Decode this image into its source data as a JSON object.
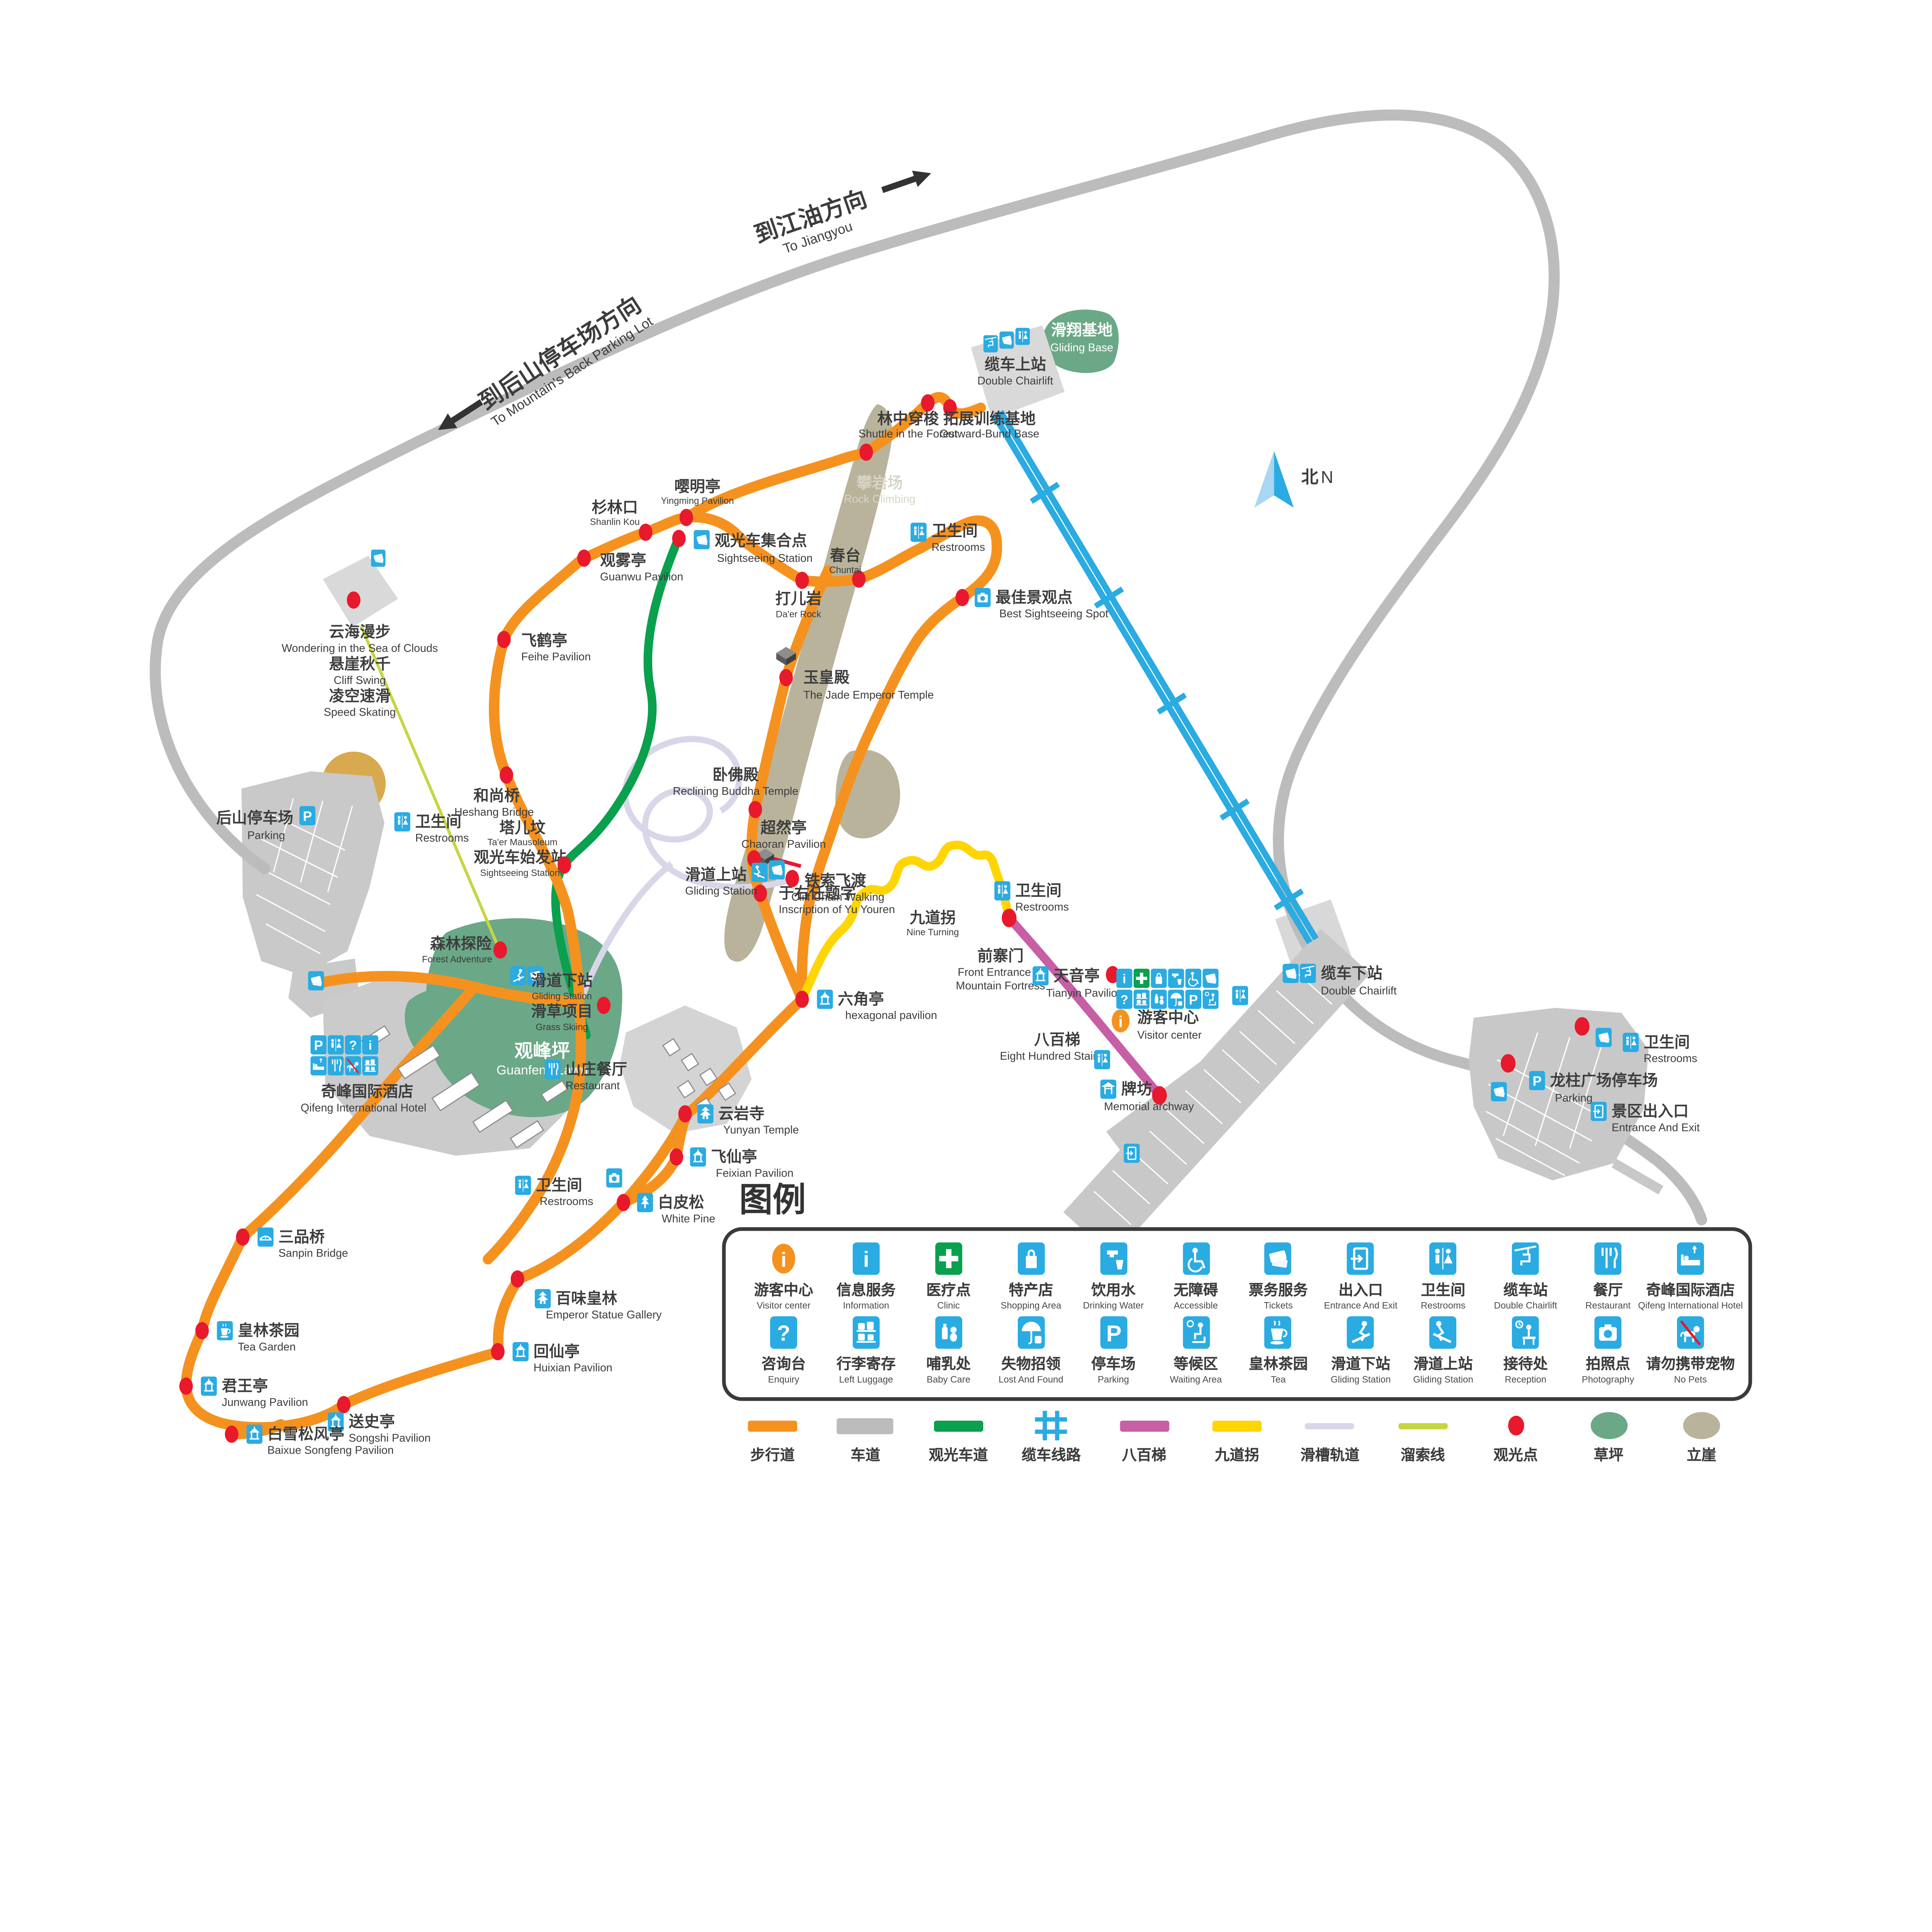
{
  "map": {
    "compass": {
      "zh": "北",
      "en": "N"
    },
    "directions": {
      "jiangyou": {
        "zh": "到江油方向",
        "en": "To Jiangyou"
      },
      "backparking": {
        "zh": "到后山停车场方向",
        "en": "To Mountain's Back Parking Lot"
      }
    },
    "pois": {
      "glidingBase": {
        "zh": "滑翔基地",
        "en": "Gliding Base"
      },
      "chairliftTop": {
        "zh": "缆车上站",
        "en": "Double Chairlift"
      },
      "chairliftBottom": {
        "zh": "缆车下站",
        "en": "Double Chairlift"
      },
      "shuttleForest": {
        "zh": "林中穿梭",
        "en": "Shuttle in the Forest"
      },
      "outwardBase": {
        "zh": "拓展训练基地",
        "en": "Outward-Bund Base"
      },
      "rockClimbing": {
        "zh": "攀岩场",
        "en": "Rock Climbing"
      },
      "shanlinkou": {
        "zh": "杉林口",
        "en": "Shanlin Kou"
      },
      "yingming": {
        "zh": "嘤明亭",
        "en": "Yingming Pavilion"
      },
      "sightseeingStation": {
        "zh": "观光车集合点",
        "en": "Sightseeing Station"
      },
      "restrooms": {
        "zh": "卫生间",
        "en": "Restrooms"
      },
      "chuntai": {
        "zh": "春台",
        "en": "Chuntai"
      },
      "daerRock": {
        "zh": "打儿岩",
        "en": "Da'er Rock"
      },
      "bestSpot": {
        "zh": "最佳景观点",
        "en": "Best Sightseeing Spot"
      },
      "guanwu": {
        "zh": "观雾亭",
        "en": "Guanwu Pavilion"
      },
      "feihe": {
        "zh": "飞鹤亭",
        "en": "Feihe Pavilion"
      },
      "seaOfClouds": {
        "zh": "云海漫步",
        "en": "Wondering in the Sea of Clouds"
      },
      "cliffSwing": {
        "zh": "悬崖秋千",
        "en": "Cliff Swing"
      },
      "speedSkating": {
        "zh": "凌空速滑",
        "en": "Speed Skating"
      },
      "jadeEmperor": {
        "zh": "玉皇殿",
        "en": "The Jade Emperor Temple"
      },
      "recliningBuddha": {
        "zh": "卧佛殿",
        "en": "Reclining Buddha Temple"
      },
      "chaoran": {
        "zh": "超然亭",
        "en": "Chaoran Pavilion"
      },
      "cliffChain": {
        "zh": "铁索飞渡",
        "en": "Cliff Chain Walking"
      },
      "yuYouren": {
        "zh": "于右任题字",
        "en": "Inscription of Yu Youren"
      },
      "heshang": {
        "zh": "和尚桥",
        "en": "Heshang Bridge"
      },
      "glidingUpper": {
        "zh": "滑道上站",
        "en": "Gliding Station"
      },
      "taerMausoleum": {
        "zh": "塔儿坟",
        "en": "Ta'er Mausoleum"
      },
      "sightseeingStart": {
        "zh": "观光车始发站",
        "en": "Sightseeing Station"
      },
      "forestAdventure": {
        "zh": "森林探险",
        "en": "Forest Adventure"
      },
      "glidingLower": {
        "zh": "滑道下站",
        "en": "Gliding Station"
      },
      "grassSkiing": {
        "zh": "滑草项目",
        "en": "Grass Skiing"
      },
      "guanfengLawn": {
        "zh": "观峰坪",
        "en": "Guanfeng Lawn"
      },
      "backParking": {
        "zh": "后山停车场",
        "en": "Parking"
      },
      "hotel": {
        "zh": "奇峰国际酒店",
        "en": "Qifeng International Hotel"
      },
      "villaRestaurant": {
        "zh": "山庄餐厅",
        "en": "Restaurant"
      },
      "yunyan": {
        "zh": "云岩寺",
        "en": "Yunyan Temple"
      },
      "feixian": {
        "zh": "飞仙亭",
        "en": "Feixian Pavilion"
      },
      "whitePine": {
        "zh": "白皮松",
        "en": "White Pine"
      },
      "sanpin": {
        "zh": "三品桥",
        "en": "Sanpin Bridge"
      },
      "emperorGallery": {
        "zh": "百味皇林",
        "en": "Emperor Statue Gallery"
      },
      "teaGarden": {
        "zh": "皇林茶园",
        "en": "Tea Garden"
      },
      "huixian": {
        "zh": "回仙亭",
        "en": "Huixian Pavilion"
      },
      "junwang": {
        "zh": "君王亭",
        "en": "Junwang Pavilion"
      },
      "songshi": {
        "zh": "送史亭",
        "en": "Songshi Pavilion"
      },
      "baixue": {
        "zh": "白雪松风亭",
        "en": "Baixue Songfeng Pavilion"
      },
      "hexagonal": {
        "zh": "六角亭",
        "en": "hexagonal pavilion"
      },
      "nineTurning": {
        "zh": "九道拐",
        "en": "Nine Turning"
      },
      "frontEntrance": {
        "zh": "前寨门",
        "en1": "Front Entrance of",
        "en2": "Mountain Fortress"
      },
      "tianyin": {
        "zh": "天音亭",
        "en": "Tianyin Pavilion"
      },
      "eightHundred": {
        "zh": "八百梯",
        "en": "Eight Hundred Stairs"
      },
      "archway": {
        "zh": "牌坊",
        "en": "Memorial archway"
      },
      "visitorCenter": {
        "zh": "游客中心",
        "en": "Visitor center"
      },
      "longzhuParking": {
        "zh": "龙柱广场停车场",
        "en": "Parking"
      },
      "entranceExit": {
        "zh": "景区出入口",
        "en": "Entrance And Exit"
      }
    }
  },
  "legend": {
    "title": "图例",
    "row1": [
      {
        "zh": "游客中心",
        "en": "Visitor center",
        "icon": "visitor-center-icon"
      },
      {
        "zh": "信息服务",
        "en": "Information",
        "icon": "information-icon"
      },
      {
        "zh": "医疗点",
        "en": "Clinic",
        "icon": "clinic-icon"
      },
      {
        "zh": "特产店",
        "en": "Shopping Area",
        "icon": "shopping-icon"
      },
      {
        "zh": "饮用水",
        "en": "Drinking Water",
        "icon": "drinking-water-icon"
      },
      {
        "zh": "无障碍",
        "en": "Accessible",
        "icon": "accessible-icon"
      },
      {
        "zh": "票务服务",
        "en": "Tickets",
        "icon": "tickets-icon"
      },
      {
        "zh": "出入口",
        "en": "Entrance And Exit",
        "icon": "entrance-exit-icon"
      },
      {
        "zh": "卫生间",
        "en": "Restrooms",
        "icon": "restrooms-icon"
      },
      {
        "zh": "缆车站",
        "en": "Double Chairlift",
        "icon": "chairlift-icon"
      },
      {
        "zh": "餐厅",
        "en": "Restaurant",
        "icon": "restaurant-icon"
      },
      {
        "zh": "奇峰国际酒店",
        "en": "Qifeng International Hotel",
        "icon": "hotel-icon"
      }
    ],
    "row2": [
      {
        "zh": "咨询台",
        "en": "Enquiry",
        "icon": "enquiry-icon"
      },
      {
        "zh": "行李寄存",
        "en": "Left Luggage",
        "icon": "left-luggage-icon"
      },
      {
        "zh": "哺乳处",
        "en": "Baby Care",
        "icon": "baby-care-icon"
      },
      {
        "zh": "失物招领",
        "en": "Lost And Found",
        "icon": "lost-found-icon"
      },
      {
        "zh": "停车场",
        "en": "Parking",
        "icon": "parking-icon"
      },
      {
        "zh": "等候区",
        "en": "Waiting Area",
        "icon": "waiting-area-icon"
      },
      {
        "zh": "皇林茶园",
        "en": "Tea",
        "icon": "tea-icon"
      },
      {
        "zh": "滑道下站",
        "en": "Gliding Station",
        "icon": "gliding-down-icon"
      },
      {
        "zh": "滑道上站",
        "en": "Gliding Station",
        "icon": "gliding-up-icon"
      },
      {
        "zh": "接待处",
        "en": "Reception",
        "icon": "reception-icon"
      },
      {
        "zh": "拍照点",
        "en": "Photography",
        "icon": "photography-icon"
      },
      {
        "zh": "请勿携带宠物",
        "en": "No Pets",
        "icon": "no-pets-icon"
      }
    ],
    "lines": [
      {
        "label": "步行道",
        "color": "#f5921f",
        "type": "bar"
      },
      {
        "label": "车道",
        "color": "#bcbcbc",
        "type": "bar"
      },
      {
        "label": "观光车道",
        "color": "#0aa04e",
        "type": "bar"
      },
      {
        "label": "缆车线路",
        "color": "#2aabe2",
        "type": "ladder"
      },
      {
        "label": "八百梯",
        "color": "#c75fa5",
        "type": "bar"
      },
      {
        "label": "九道拐",
        "color": "#ffd503",
        "type": "bar"
      },
      {
        "label": "滑槽轨道",
        "color": "#d7d7e8",
        "type": "bar-thin"
      },
      {
        "label": "溜索线",
        "color": "#c6d641",
        "type": "bar-thin"
      },
      {
        "label": "观光点",
        "color": "#e8192c",
        "type": "dot"
      },
      {
        "label": "草坪",
        "color": "#6ba888",
        "type": "blob"
      },
      {
        "label": "立崖",
        "color": "#b9b39c",
        "type": "blob"
      }
    ]
  },
  "colors": {
    "walking": "#f5921f",
    "road": "#bcbcbc",
    "busRoad": "#0aa04e",
    "cable": "#2aabe2",
    "stairs": "#c75fa5",
    "nineTurn": "#ffd503",
    "chute": "#d7d7e8",
    "zipline": "#c6d641",
    "spot": "#e8192c",
    "lawn": "#6ba888",
    "cliff": "#b9b39c",
    "iconBlue": "#2aabe2",
    "visitorOrange": "#f5921f"
  }
}
